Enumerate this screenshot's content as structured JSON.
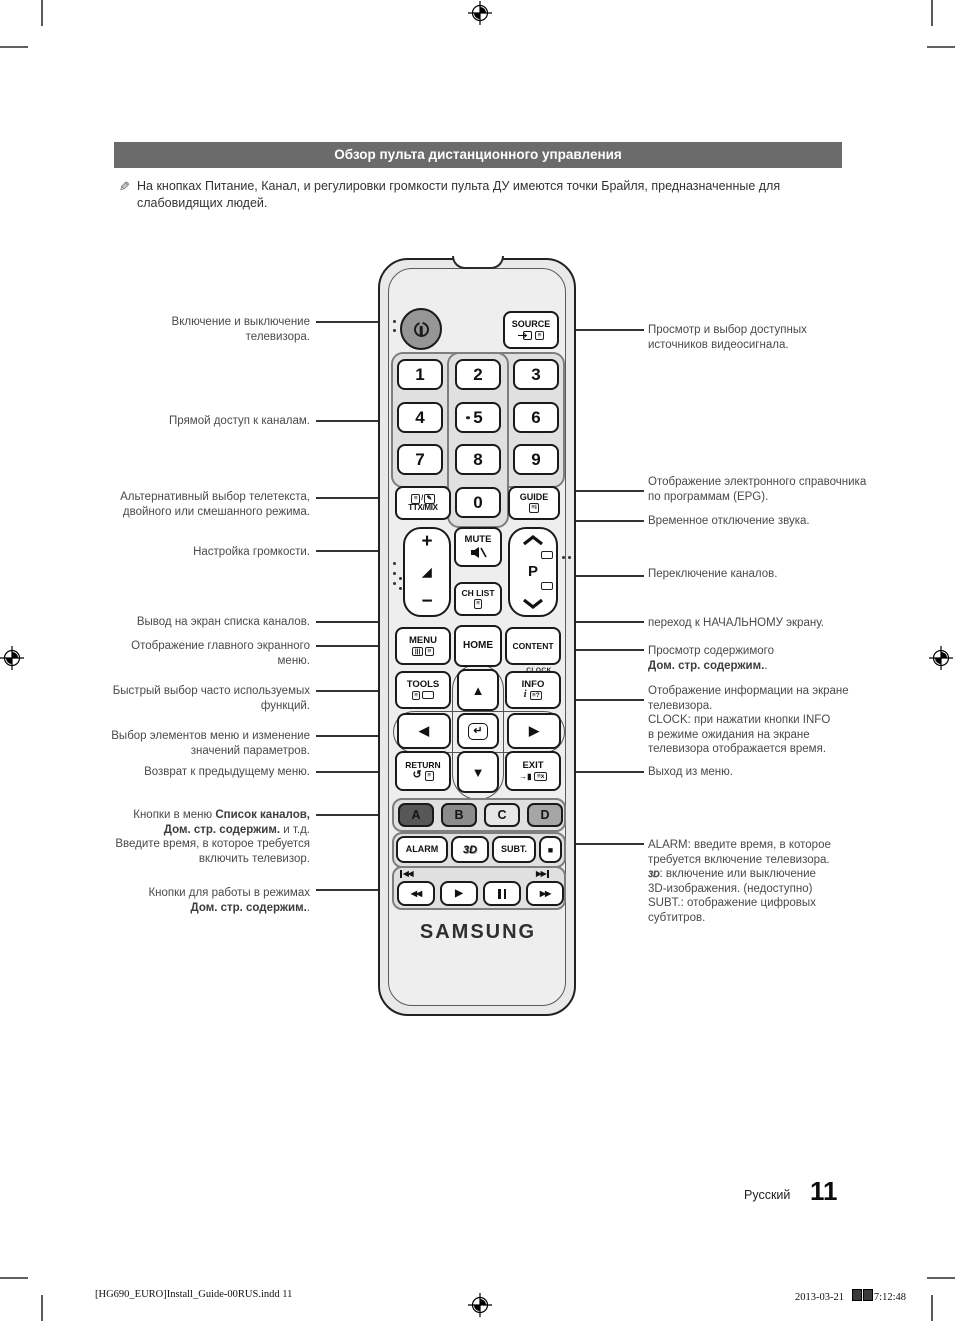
{
  "page": {
    "header": "Обзор пульта дистанционного управления",
    "note": "На кнопках Питание, Канал, и регулировки громкости пульта ДУ имеются точки Брайля, предназначенные для слабовидящих людей.",
    "lang": "Русский",
    "page_number": "11",
    "print_left": "[HG690_EURO]Install_Guide-00RUS.indd   11",
    "print_date": "2013-03-21",
    "print_time": "7:12:48"
  },
  "remote": {
    "brand": "SAMSUNG",
    "source": "SOURCE",
    "digits": [
      "1",
      "2",
      "3",
      "4",
      "5",
      "6",
      "7",
      "8",
      "9",
      "0"
    ],
    "ttxmix": "TTX/MIX",
    "guide": "GUIDE",
    "mute": "MUTE",
    "chlist": "CH LIST",
    "p": "P",
    "menu": "MENU",
    "home": "HOME",
    "content": "CONTENT",
    "clock": "CLOCK",
    "tools": "TOOLS",
    "info": "INFO",
    "return": "RETURN",
    "exit": "EXIT",
    "color_buttons": [
      "A",
      "B",
      "C",
      "D"
    ],
    "color_hex": {
      "a": "#575757",
      "b": "#8b8b8b",
      "c": "#e6e6e6",
      "d": "#a6a6a6"
    },
    "alarm": "ALARM",
    "threed": "3D",
    "subt": "SUBT."
  },
  "icons": {
    "up": "▲",
    "down": "▼",
    "left": "◀",
    "right": "▶",
    "plus": "+",
    "minus": "−",
    "vol": "◢",
    "enter": "↵",
    "return_arrow": "↺",
    "stop": "■",
    "play": "▶",
    "rew": "◀◀",
    "ff": "▶▶",
    "pause_label": "❚❚",
    "list": "≡",
    "list_q": "≡?",
    "list_x": "≡x",
    "list_i": "≡i",
    "menu_cols": "|||",
    "info_i": "i",
    "slash": "/",
    "pencil": "✎",
    "exit_door": "→▮"
  },
  "callouts_left": [
    {
      "l1": "Включение и выключение",
      "l2": "телевизора."
    },
    {
      "l1": "Прямой доступ к каналам."
    },
    {
      "l1": "Альтернативный выбор телетекста,",
      "l2": "двойного или смешанного режима."
    },
    {
      "l1": "Настройка громкости."
    },
    {
      "l1": "Вывод на экран списка каналов."
    },
    {
      "l1": "Отображение главного экранного",
      "l2": "меню."
    },
    {
      "l1": "Быстрый выбор часто используемых",
      "l2": "функций."
    },
    {
      "l1": "Выбор элементов меню и изменение",
      "l2": "значений параметров."
    },
    {
      "l1": "Возврат к предыдущему меню."
    },
    {
      "pre": "Кнопки в меню ",
      "b1": "Список каналов,",
      "b2": "Дом. стр. содержим.",
      "mid": " и т.д.",
      "l3": "Введите время, в которое требуется",
      "l4": "включить телевизор."
    },
    {
      "l1": "Кнопки для работы в режимах",
      "b1": "Дом. стр. содержим.",
      "post": "."
    }
  ],
  "callouts_right": [
    {
      "l1": "Просмотр и выбор доступных",
      "l2": "источников видеосигнала."
    },
    {
      "l1": "Отображение электронного справочника",
      "l2": "по программам (EPG)."
    },
    {
      "l1": "Временное отключение звука."
    },
    {
      "l1": "Переключение каналов."
    },
    {
      "l1": "переход к НАЧАЛЬНОМУ экрану."
    },
    {
      "l1": "Просмотр содержимого",
      "b1": "Дом. стр. содержим.",
      "post": "."
    },
    {
      "l1": "Отображение информации на экране",
      "l2": "телевизора.",
      "l3": "CLOCK: при нажатии кнопки INFO",
      "l4": "в режиме ожидания на экране",
      "l5": "телевизора отображается время."
    },
    {
      "l1": "Выход из меню."
    },
    {
      "l1": "ALARM: введите время, в которое",
      "l2": "требуется включение телевизора.",
      "icon": "3D",
      "l3": ": включение или выключение",
      "l4": "3D-изображения. (недоступно)",
      "l5": "SUBT.: отображение цифровых",
      "l6": "субтитров."
    }
  ]
}
